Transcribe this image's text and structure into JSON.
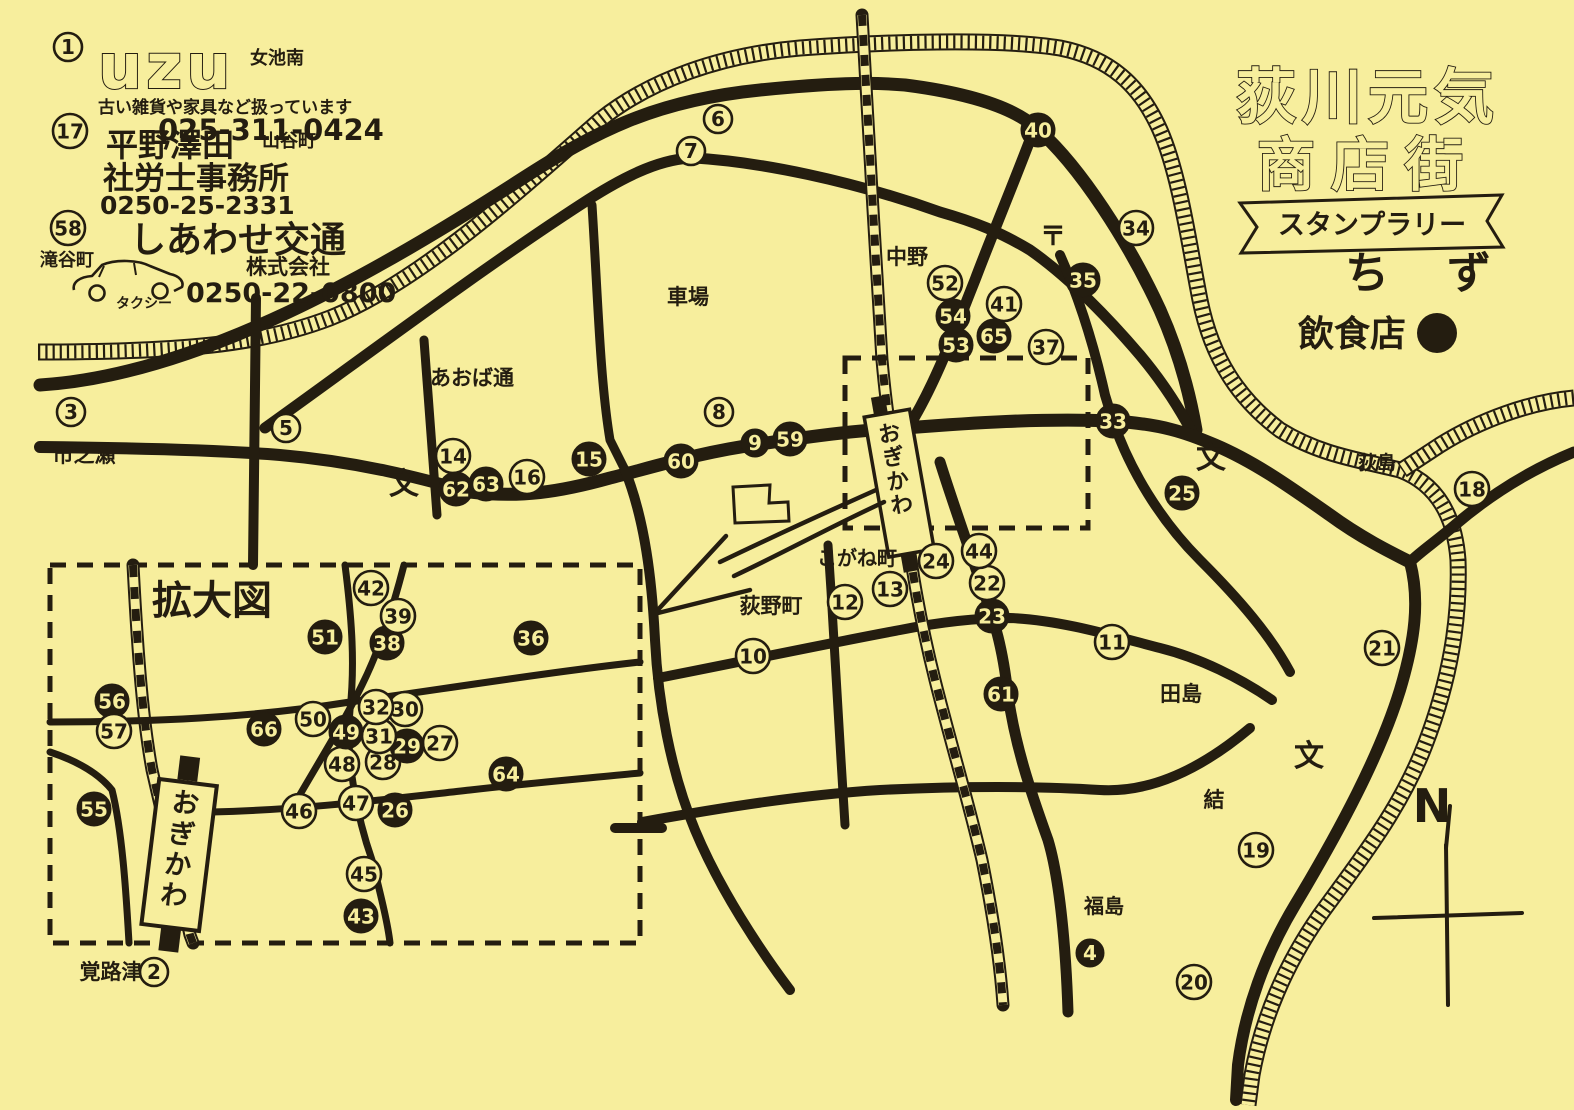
{
  "colors": {
    "paper": "#f7ee9d",
    "ink": "#241d10"
  },
  "title": {
    "line1": "荻川元気",
    "line2": "商店街",
    "banner": "スタンプラリー",
    "map_word": "ちず",
    "legend_label": "飲食店"
  },
  "compass": {
    "north_label": "N"
  },
  "inset": {
    "title": "拡大図"
  },
  "stations": {
    "main_label": "おぎかわ",
    "inset_label": "おぎかわ"
  },
  "ads": [
    {
      "number": "1",
      "name": "uzu",
      "area": "女池南",
      "desc": "古い雑貨や家具など扱っています",
      "phone": "025-311-0424"
    },
    {
      "number": "17",
      "name": "平野澤田",
      "line2": "社労士事務所",
      "area": "山谷町",
      "phone": "0250-25-2331"
    },
    {
      "number": "58",
      "name": "しあわせ交通",
      "line2": "株式会社",
      "area": "滝谷町",
      "vehicle": "タクシー",
      "phone": "0250-22-0800"
    }
  ],
  "place_labels": [
    {
      "text": "市之瀬",
      "x": 84,
      "y": 462,
      "size": 21
    },
    {
      "text": "あおば通",
      "x": 472,
      "y": 385,
      "size": 21
    },
    {
      "text": "車場",
      "x": 688,
      "y": 304,
      "size": 21
    },
    {
      "text": "中野",
      "x": 907,
      "y": 264,
      "size": 21
    },
    {
      "text": "〒",
      "x": 1053,
      "y": 245,
      "size": 26
    },
    {
      "text": "こがね町",
      "x": 857,
      "y": 565,
      "size": 20
    },
    {
      "text": "荻野町",
      "x": 771,
      "y": 613,
      "size": 21
    },
    {
      "text": "田島",
      "x": 1181,
      "y": 701,
      "size": 21
    },
    {
      "text": "結",
      "x": 1214,
      "y": 807,
      "size": 21
    },
    {
      "text": "福島",
      "x": 1104,
      "y": 913,
      "size": 20
    },
    {
      "text": "荻島",
      "x": 1377,
      "y": 469,
      "size": 19
    },
    {
      "text": "覚路津",
      "x": 111,
      "y": 979,
      "size": 21
    },
    {
      "text": "文",
      "x": 404,
      "y": 494,
      "size": 30
    },
    {
      "text": "文",
      "x": 1211,
      "y": 468,
      "size": 30
    },
    {
      "text": "文",
      "x": 1309,
      "y": 766,
      "size": 30
    },
    {
      "text": "拡大図",
      "x": 212,
      "y": 614,
      "size": 40
    }
  ],
  "markers": [
    {
      "n": 1,
      "x": 68,
      "y": 47,
      "filled": false
    },
    {
      "n": 2,
      "x": 154,
      "y": 972,
      "filled": false
    },
    {
      "n": 3,
      "x": 71,
      "y": 412,
      "filled": false
    },
    {
      "n": 4,
      "x": 1090,
      "y": 953,
      "filled": true
    },
    {
      "n": 5,
      "x": 286,
      "y": 428,
      "filled": false
    },
    {
      "n": 6,
      "x": 718,
      "y": 119,
      "filled": false
    },
    {
      "n": 7,
      "x": 691,
      "y": 151,
      "filled": false
    },
    {
      "n": 8,
      "x": 719,
      "y": 412,
      "filled": false
    },
    {
      "n": 9,
      "x": 755,
      "y": 443,
      "filled": true
    },
    {
      "n": 10,
      "x": 753,
      "y": 656,
      "filled": false
    },
    {
      "n": 11,
      "x": 1112,
      "y": 642,
      "filled": false
    },
    {
      "n": 12,
      "x": 845,
      "y": 602,
      "filled": false
    },
    {
      "n": 13,
      "x": 890,
      "y": 589,
      "filled": false
    },
    {
      "n": 14,
      "x": 453,
      "y": 456,
      "filled": false
    },
    {
      "n": 15,
      "x": 589,
      "y": 459,
      "filled": true
    },
    {
      "n": 16,
      "x": 527,
      "y": 477,
      "filled": false
    },
    {
      "n": 17,
      "x": 70,
      "y": 131,
      "filled": false
    },
    {
      "n": 18,
      "x": 1472,
      "y": 489,
      "filled": false
    },
    {
      "n": 19,
      "x": 1256,
      "y": 850,
      "filled": false
    },
    {
      "n": 20,
      "x": 1194,
      "y": 982,
      "filled": false
    },
    {
      "n": 21,
      "x": 1382,
      "y": 648,
      "filled": false
    },
    {
      "n": 22,
      "x": 987,
      "y": 583,
      "filled": false
    },
    {
      "n": 23,
      "x": 992,
      "y": 616,
      "filled": true
    },
    {
      "n": 24,
      "x": 936,
      "y": 561,
      "filled": false
    },
    {
      "n": 25,
      "x": 1182,
      "y": 493,
      "filled": true
    },
    {
      "n": 26,
      "x": 395,
      "y": 810,
      "filled": true
    },
    {
      "n": 27,
      "x": 440,
      "y": 743,
      "filled": false
    },
    {
      "n": 28,
      "x": 383,
      "y": 762,
      "filled": false
    },
    {
      "n": 29,
      "x": 407,
      "y": 746,
      "filled": true
    },
    {
      "n": 30,
      "x": 405,
      "y": 709,
      "filled": false
    },
    {
      "n": 31,
      "x": 379,
      "y": 736,
      "filled": false
    },
    {
      "n": 32,
      "x": 376,
      "y": 707,
      "filled": false
    },
    {
      "n": 33,
      "x": 1113,
      "y": 421,
      "filled": true
    },
    {
      "n": 34,
      "x": 1136,
      "y": 228,
      "filled": false
    },
    {
      "n": 35,
      "x": 1083,
      "y": 280,
      "filled": true
    },
    {
      "n": 36,
      "x": 531,
      "y": 638,
      "filled": true
    },
    {
      "n": 37,
      "x": 1046,
      "y": 347,
      "filled": false
    },
    {
      "n": 38,
      "x": 387,
      "y": 643,
      "filled": true
    },
    {
      "n": 39,
      "x": 398,
      "y": 616,
      "filled": false
    },
    {
      "n": 40,
      "x": 1038,
      "y": 130,
      "filled": true
    },
    {
      "n": 41,
      "x": 1004,
      "y": 304,
      "filled": false
    },
    {
      "n": 42,
      "x": 371,
      "y": 588,
      "filled": false
    },
    {
      "n": 43,
      "x": 361,
      "y": 916,
      "filled": true
    },
    {
      "n": 44,
      "x": 979,
      "y": 551,
      "filled": false
    },
    {
      "n": 45,
      "x": 364,
      "y": 874,
      "filled": false
    },
    {
      "n": 46,
      "x": 299,
      "y": 811,
      "filled": false
    },
    {
      "n": 47,
      "x": 356,
      "y": 803,
      "filled": false
    },
    {
      "n": 48,
      "x": 342,
      "y": 764,
      "filled": false
    },
    {
      "n": 49,
      "x": 346,
      "y": 732,
      "filled": true
    },
    {
      "n": 50,
      "x": 313,
      "y": 719,
      "filled": false
    },
    {
      "n": 51,
      "x": 325,
      "y": 637,
      "filled": true
    },
    {
      "n": 52,
      "x": 945,
      "y": 283,
      "filled": false
    },
    {
      "n": 53,
      "x": 956,
      "y": 345,
      "filled": true
    },
    {
      "n": 54,
      "x": 953,
      "y": 316,
      "filled": true
    },
    {
      "n": 55,
      "x": 94,
      "y": 809,
      "filled": true
    },
    {
      "n": 56,
      "x": 112,
      "y": 701,
      "filled": true
    },
    {
      "n": 57,
      "x": 114,
      "y": 731,
      "filled": false
    },
    {
      "n": 58,
      "x": 68,
      "y": 228,
      "filled": false
    },
    {
      "n": 59,
      "x": 790,
      "y": 439,
      "filled": true
    },
    {
      "n": 60,
      "x": 681,
      "y": 461,
      "filled": true
    },
    {
      "n": 61,
      "x": 1001,
      "y": 694,
      "filled": true
    },
    {
      "n": 62,
      "x": 456,
      "y": 489,
      "filled": true
    },
    {
      "n": 63,
      "x": 486,
      "y": 484,
      "filled": true
    },
    {
      "n": 64,
      "x": 506,
      "y": 774,
      "filled": true
    },
    {
      "n": 65,
      "x": 994,
      "y": 336,
      "filled": true
    },
    {
      "n": 66,
      "x": 264,
      "y": 729,
      "filled": true
    }
  ]
}
